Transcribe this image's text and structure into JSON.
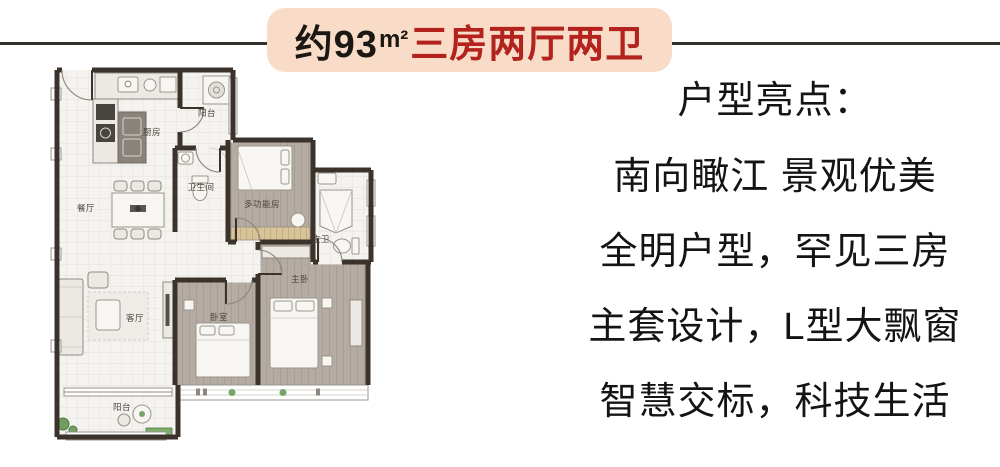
{
  "banner": {
    "area_prefix": "约93",
    "area_unit": "m²",
    "type_label": "三房两厅两卫",
    "bg_color": "#f9dcc8",
    "prefix_color": "#1b1713",
    "type_color": "#b3221d"
  },
  "divider": {
    "color": "#33302c"
  },
  "highlights": {
    "heading": "户型亮点：",
    "lines": [
      "南向瞰江 景观优美",
      "全明户型，罕见三房",
      "主套设计，L型大飘窗",
      "智慧交标，科技生活"
    ]
  },
  "floorplan": {
    "wall_color": "#3a322b",
    "rooms": {
      "kitchen": {
        "label": "厨房"
      },
      "balcony_top": {
        "label": "阳台"
      },
      "bathroom": {
        "label": "卫生间"
      },
      "multi_function_room": {
        "label": "多功能房"
      },
      "master_bathroom": {
        "label": "主卫"
      },
      "master_bedroom": {
        "label": "主卧"
      },
      "bedroom": {
        "label": "卧室"
      },
      "living_room": {
        "label": "客厅"
      },
      "dining_room": {
        "label": "餐厅"
      },
      "balcony_bottom": {
        "label": "阳台"
      }
    }
  }
}
